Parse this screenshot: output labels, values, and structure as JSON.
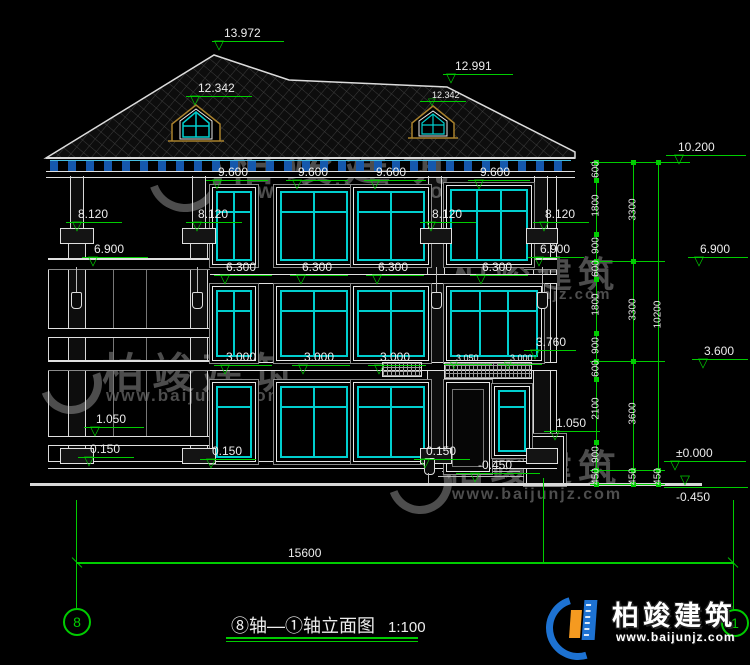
{
  "title": {
    "axis_label": "⑧轴—①轴立面图",
    "scale": "1:100"
  },
  "axis_bubbles": {
    "left": "8",
    "right": "1"
  },
  "brand": {
    "name": "柏竣建筑",
    "site": "www.baijunjz.com"
  },
  "icons": {
    "elevation_triangle": "▽"
  },
  "elevations": {
    "roof_peak": "13.972",
    "roof_ridge_right": "12.991",
    "dormer": "12.342",
    "parapet_top": "10.200",
    "eave": "9.600",
    "column_capital": "8.120",
    "floor3": "6.900",
    "window3_top": "6.300",
    "floor2": "3.600",
    "window2_top": "3.000",
    "entry_lintel": "3.050",
    "entry_beam": "3.760",
    "railing": "1.050",
    "plinth": "0.150",
    "zero": "±0.000",
    "grade": "-0.450"
  },
  "dimensions": {
    "overall_width": "15600",
    "overall_height": "10200",
    "floor_heights": [
      "3300",
      "3300",
      "3600"
    ],
    "right_chain": [
      "600",
      "1800",
      "900",
      "600",
      "1800",
      "900",
      "600",
      "2100",
      "900"
    ],
    "below_grade": "450"
  }
}
